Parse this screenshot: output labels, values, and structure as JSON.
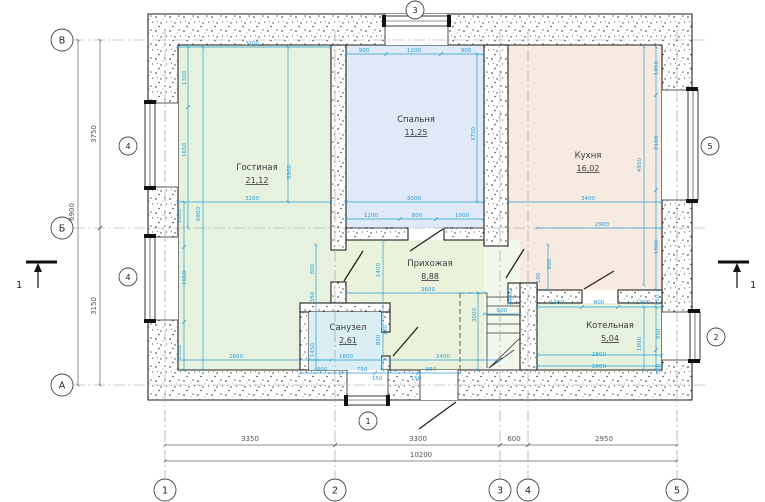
{
  "rooms": [
    {
      "name": "Гостиная",
      "area": "21,12"
    },
    {
      "name": "Спальня",
      "area": "11,25"
    },
    {
      "name": "Кухня",
      "area": "16,02"
    },
    {
      "name": "Прихожая",
      "area": "8,88"
    },
    {
      "name": "Санузел",
      "area": "2,61"
    },
    {
      "name": "Котельная",
      "area": "5,04"
    }
  ],
  "axes": {
    "rows": [
      "В",
      "Б",
      "А"
    ],
    "cols": [
      "1",
      "2",
      "3",
      "4",
      "5"
    ]
  },
  "window_tags": [
    "1",
    "2",
    "3",
    "4",
    "5"
  ],
  "section_marks": {
    "left": "1",
    "right": "1"
  },
  "outer_dims": {
    "left_spans": [
      "3750",
      "3150"
    ],
    "left_total": "6900",
    "bottom_spans": [
      "3350",
      "3300",
      "600",
      "2950"
    ],
    "bottom_total": "10200"
  },
  "colors": {
    "dim": "#2b9fd6",
    "outer_dim": "#555555",
    "living": "#e6f2de",
    "bedroom": "#dfe9f7",
    "kitchen": "#f7eae1",
    "hall": "#ebf2dc",
    "bath": "#dbeef4",
    "boiler": "#e6f2de",
    "stairs": "#f3f8ec"
  },
  "dim_labels": [
    {
      "t": "3750",
      "x": 96,
      "y": 134,
      "r": -90,
      "c": "g"
    },
    {
      "t": "3150",
      "x": 96,
      "y": 306,
      "r": -90,
      "c": "g"
    },
    {
      "t": "6900",
      "x": 74,
      "y": 212,
      "r": -90,
      "c": "g"
    },
    {
      "t": "3350",
      "x": 250,
      "y": 441,
      "c": "g"
    },
    {
      "t": "3300",
      "x": 418,
      "y": 441,
      "c": "g"
    },
    {
      "t": "600",
      "x": 514,
      "y": 441,
      "c": "g"
    },
    {
      "t": "2950",
      "x": 604,
      "y": 441,
      "c": "g"
    },
    {
      "t": "10200",
      "x": 421,
      "y": 457,
      "c": "g"
    },
    {
      "t": "3200",
      "x": 252,
      "y": 45
    },
    {
      "t": "1300",
      "x": 186,
      "y": 78,
      "r": -90
    },
    {
      "t": "1650",
      "x": 186,
      "y": 150,
      "r": -90
    },
    {
      "t": "5300",
      "x": 291,
      "y": 172,
      "r": -90
    },
    {
      "t": "3200",
      "x": 252,
      "y": 200
    },
    {
      "t": "1000",
      "x": 181,
      "y": 216,
      "r": -90
    },
    {
      "t": "6900",
      "x": 200,
      "y": 214,
      "r": -90
    },
    {
      "t": "1650",
      "x": 186,
      "y": 278,
      "r": -90
    },
    {
      "t": "800",
      "x": 314,
      "y": 269,
      "r": -90
    },
    {
      "t": "350",
      "x": 314,
      "y": 297,
      "r": -90
    },
    {
      "t": "1300",
      "x": 181,
      "y": 352,
      "r": -90
    },
    {
      "t": "2600",
      "x": 236,
      "y": 358
    },
    {
      "t": "900",
      "x": 364,
      "y": 52
    },
    {
      "t": "1200",
      "x": 414,
      "y": 52
    },
    {
      "t": "900",
      "x": 466,
      "y": 52
    },
    {
      "t": "3750",
      "x": 475,
      "y": 134,
      "r": -90
    },
    {
      "t": "3000",
      "x": 414,
      "y": 200
    },
    {
      "t": "1200",
      "x": 371,
      "y": 217
    },
    {
      "t": "800",
      "x": 417,
      "y": 217
    },
    {
      "t": "1000",
      "x": 462,
      "y": 217
    },
    {
      "t": "1050",
      "x": 658,
      "y": 68,
      "r": -90
    },
    {
      "t": "2100",
      "x": 658,
      "y": 143,
      "r": -90
    },
    {
      "t": "4950",
      "x": 641,
      "y": 165,
      "r": -90
    },
    {
      "t": "3400",
      "x": 588,
      "y": 200
    },
    {
      "t": "2900",
      "x": 602,
      "y": 226
    },
    {
      "t": "1800",
      "x": 658,
      "y": 247,
      "r": -90
    },
    {
      "t": "800",
      "x": 551,
      "y": 264,
      "r": -90
    },
    {
      "t": "100",
      "x": 540,
      "y": 278,
      "r": -90
    },
    {
      "t": "1000",
      "x": 557,
      "y": 304
    },
    {
      "t": "800",
      "x": 599,
      "y": 304
    },
    {
      "t": "1000",
      "x": 643,
      "y": 304
    },
    {
      "t": "550",
      "x": 659,
      "y": 300,
      "r": -90
    },
    {
      "t": "950",
      "x": 660,
      "y": 334,
      "r": -90
    },
    {
      "t": "1800",
      "x": 641,
      "y": 344,
      "r": -90
    },
    {
      "t": "2800",
      "x": 599,
      "y": 356
    },
    {
      "t": "2800",
      "x": 599,
      "y": 368
    },
    {
      "t": "500",
      "x": 660,
      "y": 369,
      "r": -90
    },
    {
      "t": "1400",
      "x": 380,
      "y": 270,
      "r": -90
    },
    {
      "t": "3600",
      "x": 428,
      "y": 291
    },
    {
      "t": "3000",
      "x": 476,
      "y": 315,
      "r": -90
    },
    {
      "t": "250",
      "x": 511,
      "y": 300,
      "r": -90
    },
    {
      "t": "600",
      "x": 502,
      "y": 312
    },
    {
      "t": "2400",
      "x": 443,
      "y": 358
    },
    {
      "t": "950",
      "x": 431,
      "y": 371
    },
    {
      "t": "1450",
      "x": 314,
      "y": 350,
      "r": -90
    },
    {
      "t": "1800",
      "x": 346,
      "y": 358
    },
    {
      "t": "100",
      "x": 387,
      "y": 330,
      "r": -90
    },
    {
      "t": "800",
      "x": 380,
      "y": 340,
      "r": -90
    },
    {
      "t": "900",
      "x": 322,
      "y": 371
    },
    {
      "t": "750",
      "x": 362,
      "y": 371
    },
    {
      "t": "150",
      "x": 377,
      "y": 380
    },
    {
      "t": "150",
      "x": 416,
      "y": 380
    }
  ]
}
